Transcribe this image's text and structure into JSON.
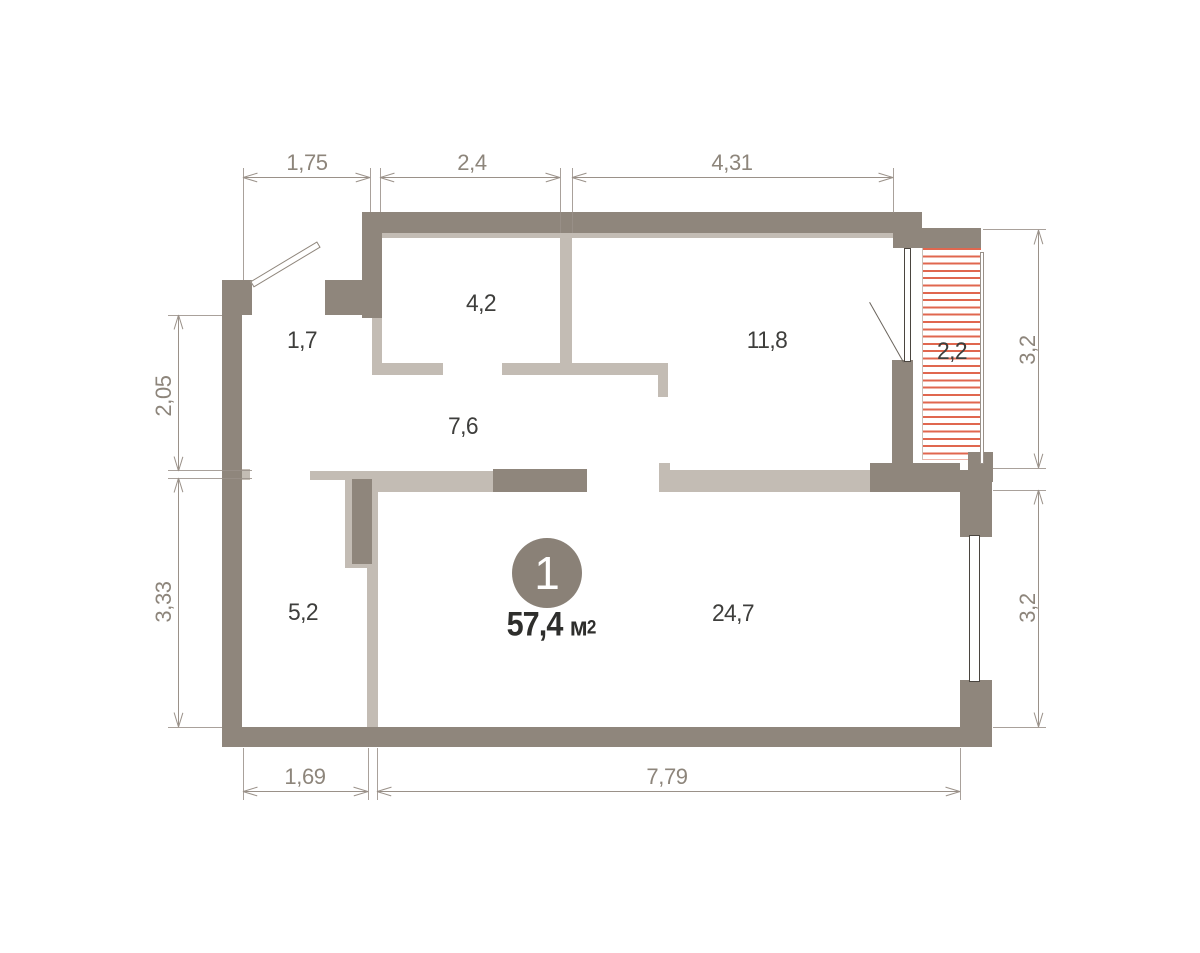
{
  "plan": {
    "unit": {
      "number": "1",
      "area_value": "57,4",
      "area_unit_base": "м",
      "area_unit_sup": "2"
    },
    "room_areas": [
      "1,7",
      "4,2",
      "7,6",
      "11,8",
      "2,2",
      "5,2",
      "24,7"
    ],
    "dimensions": {
      "top": [
        "1,75",
        "2,4",
        "4,31"
      ],
      "bottom": [
        "1,69",
        "7,79"
      ],
      "left": [
        "2,05",
        "3,33"
      ],
      "right": [
        "3,2",
        "3,2"
      ]
    },
    "colors": {
      "wall_dark": "#8f867c",
      "wall_light": "#c3bcb4",
      "dimension_gray": "#9a9189",
      "label_dark": "#3e3e3c",
      "hatch_red": "#e0674f",
      "badge_fill": "#8a8177"
    }
  }
}
